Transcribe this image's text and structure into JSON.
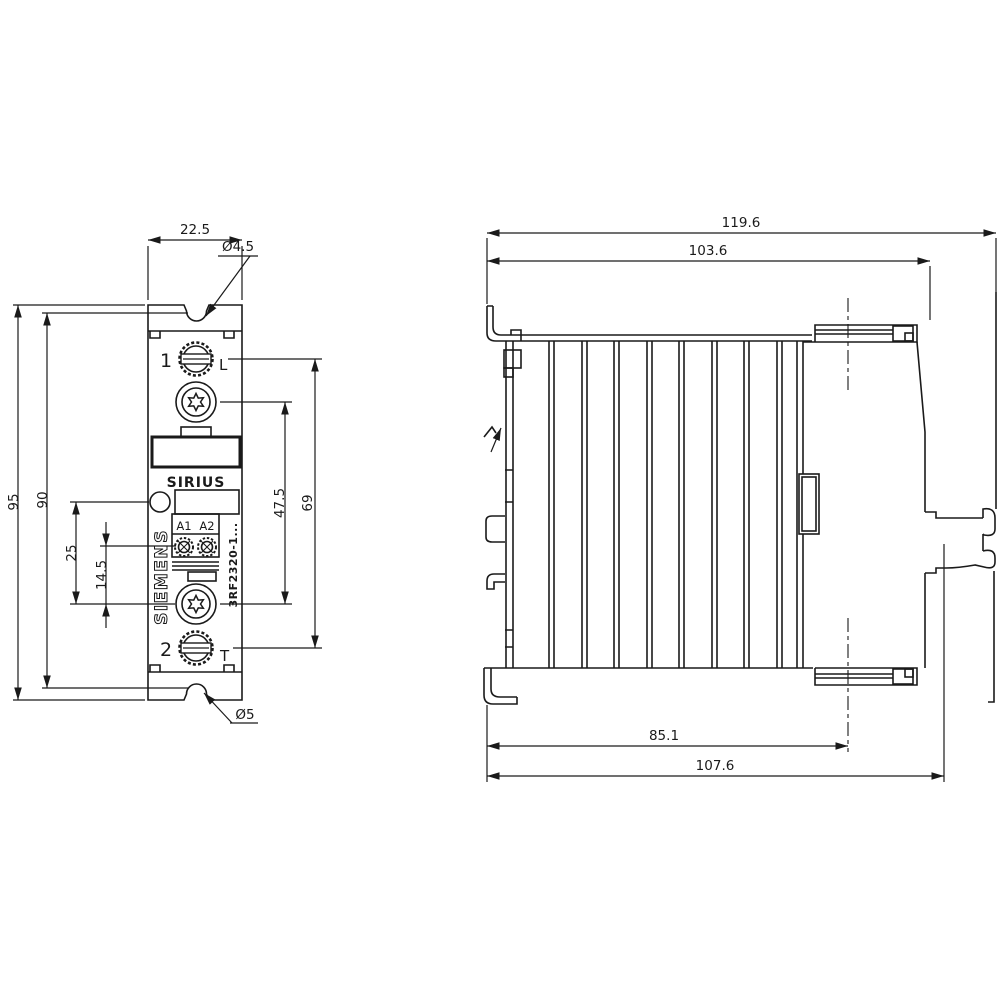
{
  "colors": {
    "line": "#1a1a1a",
    "background": "#ffffff"
  },
  "device": {
    "brand": "SIEMENS",
    "series": "SIRIUS",
    "order_number": "3RF2320-1...",
    "terminals": {
      "top_number": "1",
      "top_letter": "L",
      "bottom_number": "2",
      "bottom_letter": "T",
      "coil_left": "A1",
      "coil_right": "A2"
    }
  },
  "front_view": {
    "dims": {
      "width": "22.5",
      "top_hole": "Ø4.5",
      "height": "95",
      "hole_distance": "90",
      "led_offset": "25",
      "coil_offset": "14.5",
      "screw_distance": "47.5",
      "terminal_distance": "69",
      "bottom_hole": "Ø5"
    }
  },
  "side_view": {
    "dims": {
      "overall_depth": "119.6",
      "body_depth": "103.6",
      "screw_axis_depth": "85.1",
      "front_depth": "107.6"
    }
  }
}
